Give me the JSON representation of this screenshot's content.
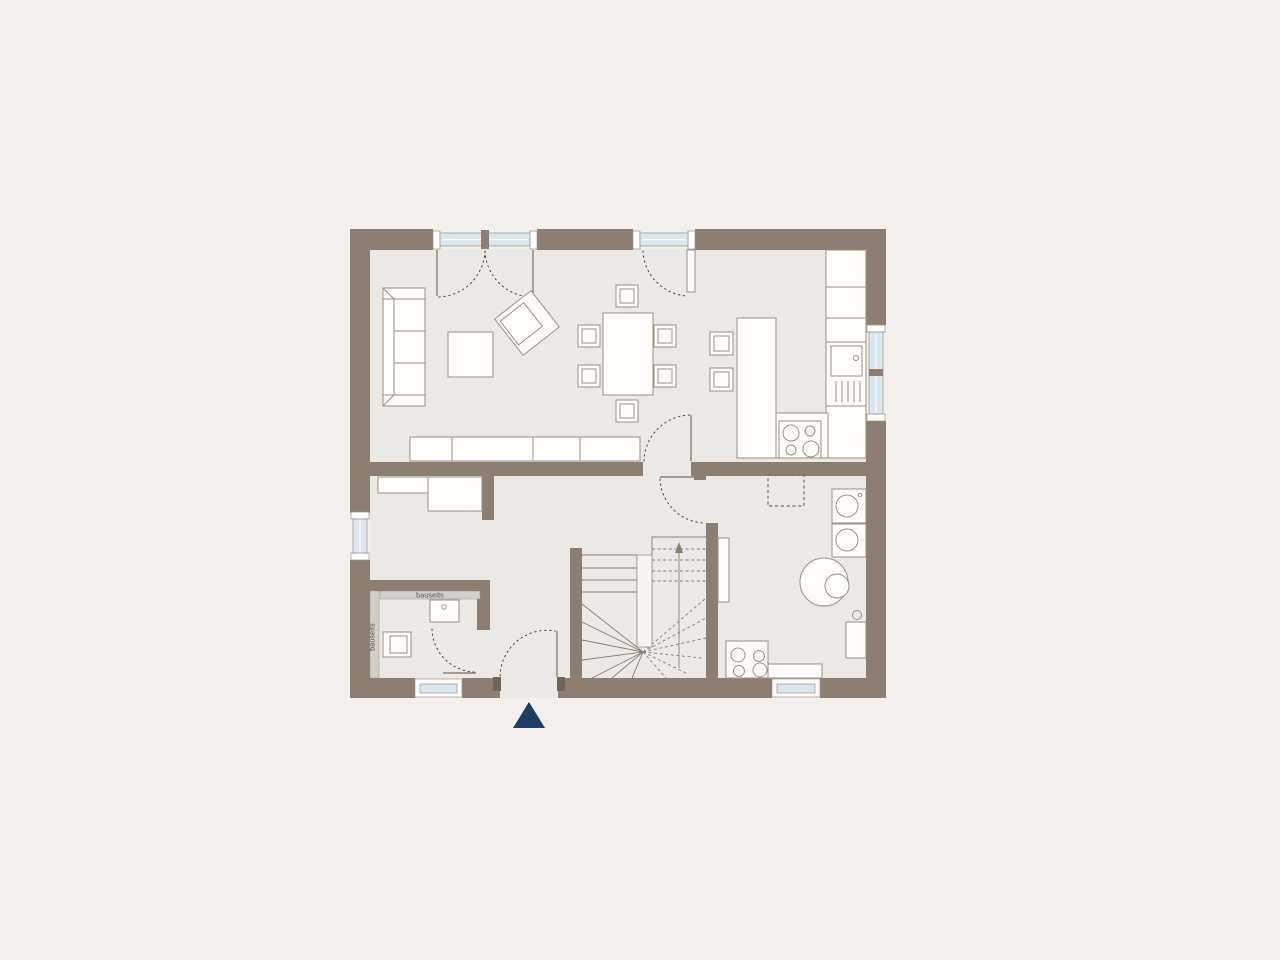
{
  "labels": {
    "bathroom_strip_top": "bauseits",
    "bathroom_strip_left": "bauseits"
  },
  "colors": {
    "background": "#f2efec",
    "floor": "#ebe9e5",
    "wall": "#8c7f71",
    "wall_dark": "#6f655a",
    "furniture_outline": "#9b9082",
    "window_glass": "#d9e6ee",
    "dashed_line": "#4f4a44",
    "fixture_strip": "#d2cfca",
    "entrance_marker": "#1e3c64"
  }
}
